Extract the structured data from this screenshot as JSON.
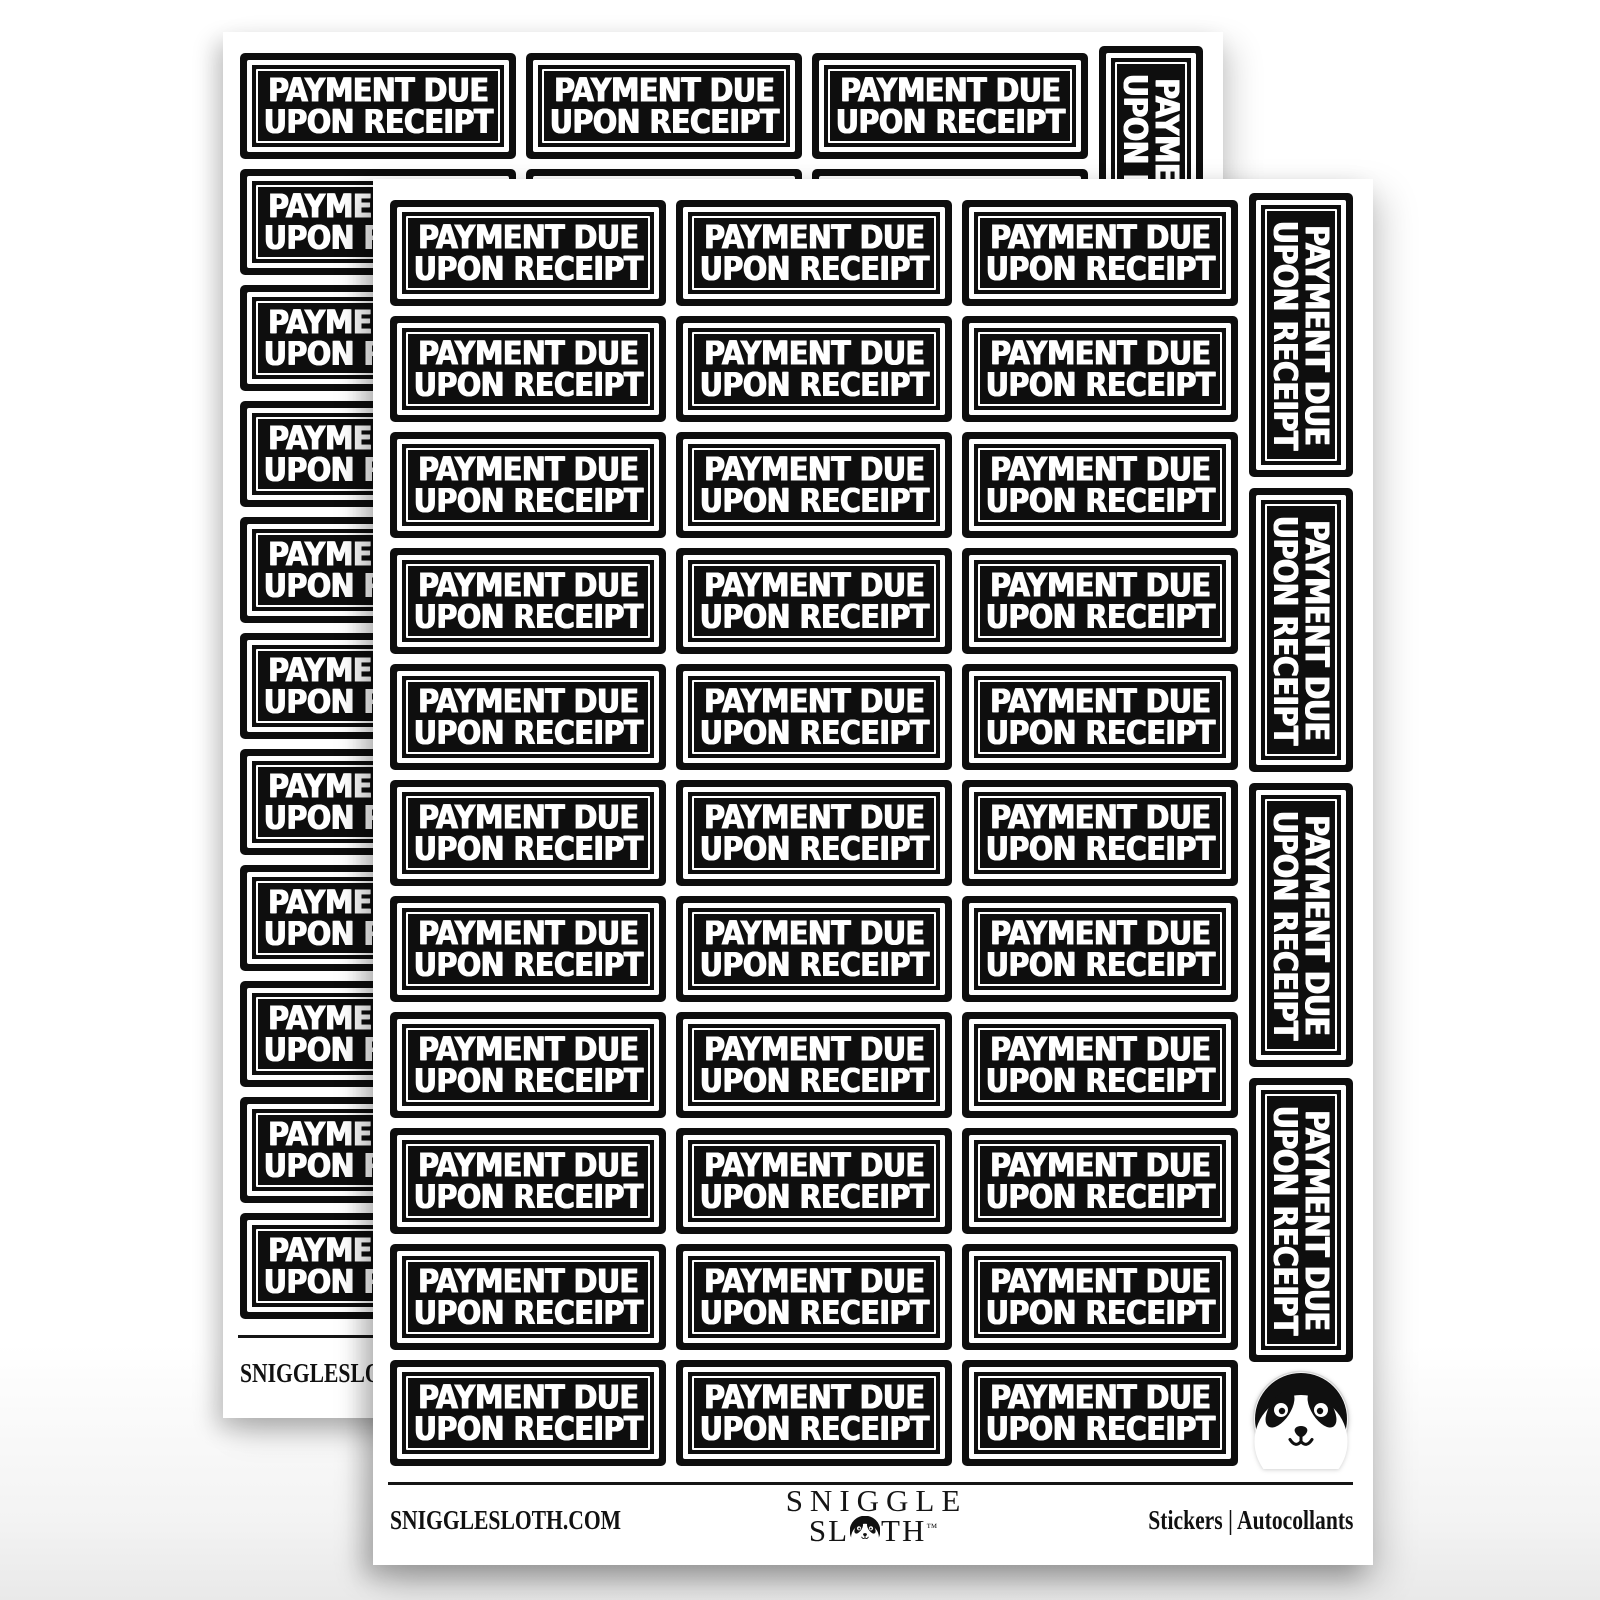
{
  "product": {
    "description": "Payment Due Upon Receipt black and white sticker sheets, two overlapping sheets",
    "sheets_count": 2
  },
  "sticker": {
    "line1": "PAYMENT DUE",
    "line2": "UPON RECEIPT"
  },
  "sheet": {
    "grid_rows": 11,
    "grid_cols": 3,
    "vertical_stickers": 4,
    "footer": {
      "left_url": "SNIGGLESLOTH.COM",
      "brand_line1": "SNIGGLE",
      "brand_line2_pre": "SL",
      "brand_line2_post": "TH",
      "brand_tm": "™",
      "right": "Stickers  |  Autocollants"
    }
  },
  "icons": {
    "sloth_face": "sloth-face",
    "logo_o_face": "sloth-face-in-letter-o"
  },
  "colors": {
    "sticker_bg": "#0e0e0e",
    "sticker_text": "#ffffff",
    "sheet_bg": "#ffffff",
    "page_bg_top": "#ffffff",
    "page_bg_bottom": "#e9e9e9",
    "divider": "#161616"
  }
}
